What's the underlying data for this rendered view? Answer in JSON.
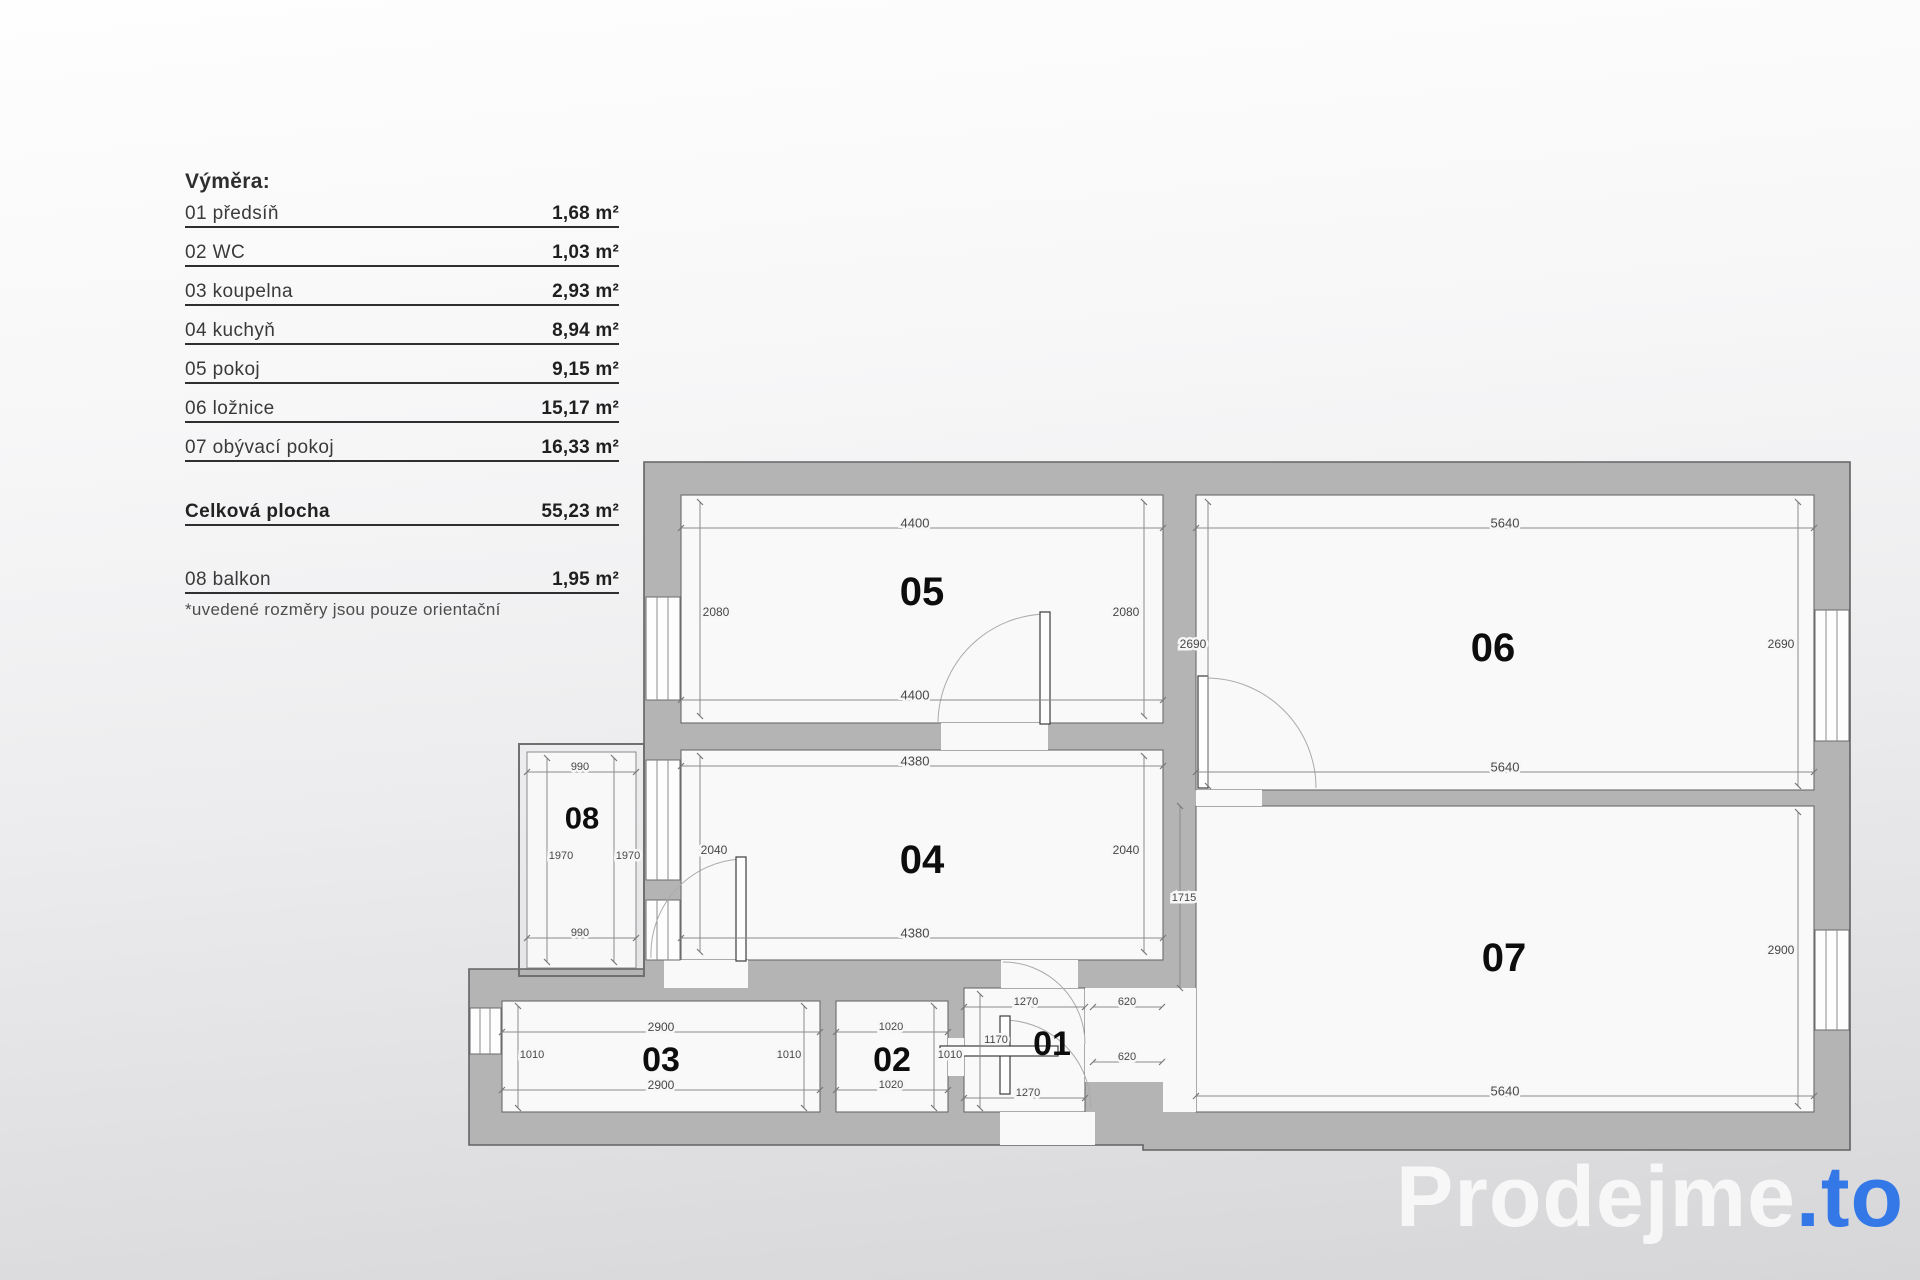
{
  "legend": {
    "title": "Výměra:",
    "rows": [
      {
        "label": "01 předsíň",
        "value": "1,68 m²"
      },
      {
        "label": "02 WC",
        "value": "1,03 m²"
      },
      {
        "label": "03 koupelna",
        "value": "2,93 m²"
      },
      {
        "label": "04 kuchyň",
        "value": "8,94 m²"
      },
      {
        "label": "05 pokoj",
        "value": "9,15 m²"
      },
      {
        "label": "06 ložnice",
        "value": "15,17 m²"
      },
      {
        "label": "07 obývací pokoj",
        "value": "16,33 m²"
      }
    ],
    "total": {
      "label": "Celková plocha",
      "value": "55,23 m²"
    },
    "balcony": {
      "label": "08 balkon",
      "value": "1,95 m²"
    },
    "note": "*uvedené rozměry jsou pouze orientační"
  },
  "plan": {
    "room_labels": [
      {
        "v": "05",
        "x": 922,
        "y": 592,
        "fs": 40
      },
      {
        "v": "06",
        "x": 1493,
        "y": 648,
        "fs": 40
      },
      {
        "v": "04",
        "x": 922,
        "y": 860,
        "fs": 40
      },
      {
        "v": "07",
        "x": 1504,
        "y": 958,
        "fs": 40
      },
      {
        "v": "08",
        "x": 582,
        "y": 818,
        "fs": 31
      },
      {
        "v": "03",
        "x": 661,
        "y": 1060,
        "fs": 34
      },
      {
        "v": "02",
        "x": 892,
        "y": 1060,
        "fs": 34
      },
      {
        "v": "01",
        "x": 1052,
        "y": 1044,
        "fs": 34
      }
    ],
    "dims": [
      {
        "v": "4400",
        "x1": 681,
        "y1": 528,
        "x2": 1163,
        "y2": 528,
        "tx": 915,
        "ty": 523,
        "fs": 13
      },
      {
        "v": "2080",
        "x1": 700,
        "y1": 502,
        "x2": 700,
        "y2": 716,
        "tx": 716,
        "ty": 612,
        "fs": 12
      },
      {
        "v": "2080",
        "x1": 1144,
        "y1": 502,
        "x2": 1144,
        "y2": 716,
        "tx": 1126,
        "ty": 612,
        "fs": 12
      },
      {
        "v": "4400",
        "x1": 681,
        "y1": 700,
        "x2": 1163,
        "y2": 700,
        "tx": 915,
        "ty": 695,
        "fs": 13
      },
      {
        "v": "5640",
        "x1": 1196,
        "y1": 528,
        "x2": 1814,
        "y2": 528,
        "tx": 1505,
        "ty": 523,
        "fs": 13
      },
      {
        "v": "2690",
        "x1": 1208,
        "y1": 502,
        "x2": 1208,
        "y2": 786,
        "tx": 1193,
        "ty": 644,
        "fs": 12
      },
      {
        "v": "2690",
        "x1": 1798,
        "y1": 502,
        "x2": 1798,
        "y2": 786,
        "tx": 1781,
        "ty": 644,
        "fs": 12
      },
      {
        "v": "5640",
        "x1": 1196,
        "y1": 772,
        "x2": 1814,
        "y2": 772,
        "tx": 1505,
        "ty": 767,
        "fs": 13
      },
      {
        "v": "4380",
        "x1": 681,
        "y1": 766,
        "x2": 1163,
        "y2": 766,
        "tx": 915,
        "ty": 761,
        "fs": 13
      },
      {
        "v": "2040",
        "x1": 700,
        "y1": 756,
        "x2": 700,
        "y2": 952,
        "tx": 714,
        "ty": 850,
        "fs": 12
      },
      {
        "v": "2040",
        "x1": 1144,
        "y1": 756,
        "x2": 1144,
        "y2": 952,
        "tx": 1126,
        "ty": 850,
        "fs": 12
      },
      {
        "v": "4380",
        "x1": 681,
        "y1": 938,
        "x2": 1163,
        "y2": 938,
        "tx": 915,
        "ty": 933,
        "fs": 13
      },
      {
        "v": "990",
        "x1": 527,
        "y1": 772,
        "x2": 636,
        "y2": 772,
        "tx": 580,
        "ty": 767,
        "fs": 11
      },
      {
        "v": "1970",
        "x1": 547,
        "y1": 758,
        "x2": 547,
        "y2": 962,
        "tx": 561,
        "ty": 856,
        "fs": 11
      },
      {
        "v": "1970",
        "x1": 614,
        "y1": 758,
        "x2": 614,
        "y2": 962,
        "tx": 628,
        "ty": 856,
        "fs": 11
      },
      {
        "v": "990",
        "x1": 527,
        "y1": 938,
        "x2": 636,
        "y2": 938,
        "tx": 580,
        "ty": 933,
        "fs": 11
      },
      {
        "v": "2900",
        "x1": 502,
        "y1": 1032,
        "x2": 820,
        "y2": 1032,
        "tx": 661,
        "ty": 1027,
        "fs": 12
      },
      {
        "v": "1010",
        "x1": 518,
        "y1": 1006,
        "x2": 518,
        "y2": 1108,
        "tx": 532,
        "ty": 1055,
        "fs": 11
      },
      {
        "v": "1010",
        "x1": 804,
        "y1": 1006,
        "x2": 804,
        "y2": 1108,
        "tx": 789,
        "ty": 1055,
        "fs": 11
      },
      {
        "v": "2900",
        "x1": 502,
        "y1": 1090,
        "x2": 820,
        "y2": 1090,
        "tx": 661,
        "ty": 1085,
        "fs": 12
      },
      {
        "v": "1020",
        "x1": 836,
        "y1": 1032,
        "x2": 948,
        "y2": 1032,
        "tx": 891,
        "ty": 1027,
        "fs": 11
      },
      {
        "v": "1010",
        "x1": 934,
        "y1": 1006,
        "x2": 934,
        "y2": 1108,
        "tx": 950,
        "ty": 1055,
        "fs": 11
      },
      {
        "v": "1020",
        "x1": 836,
        "y1": 1090,
        "x2": 948,
        "y2": 1090,
        "tx": 891,
        "ty": 1085,
        "fs": 11
      },
      {
        "v": "1270",
        "x1": 964,
        "y1": 1007,
        "x2": 1085,
        "y2": 1007,
        "tx": 1026,
        "ty": 1002,
        "fs": 11
      },
      {
        "v": "1170",
        "x1": 980,
        "y1": 994,
        "x2": 980,
        "y2": 1108,
        "tx": 996,
        "ty": 1040,
        "fs": 11
      },
      {
        "v": "1270",
        "x1": 964,
        "y1": 1098,
        "x2": 1085,
        "y2": 1098,
        "tx": 1028,
        "ty": 1093,
        "fs": 11
      },
      {
        "v": "620",
        "x1": 1093,
        "y1": 1007,
        "x2": 1162,
        "y2": 1007,
        "tx": 1127,
        "ty": 1002,
        "fs": 11
      },
      {
        "v": "620",
        "x1": 1093,
        "y1": 1062,
        "x2": 1162,
        "y2": 1062,
        "tx": 1127,
        "ty": 1057,
        "fs": 11
      },
      {
        "v": "1715",
        "x1": 1180,
        "y1": 806,
        "x2": 1180,
        "y2": 988,
        "tx": 1184,
        "ty": 898,
        "fs": 11
      },
      {
        "v": "5640",
        "x1": 1196,
        "y1": 1096,
        "x2": 1814,
        "y2": 1096,
        "tx": 1505,
        "ty": 1091,
        "fs": 13
      },
      {
        "v": "2900",
        "x1": 1798,
        "y1": 812,
        "x2": 1798,
        "y2": 1106,
        "tx": 1781,
        "ty": 950,
        "fs": 12
      }
    ]
  },
  "logo": {
    "brand": "Prodejme",
    "tld": ".to"
  },
  "colors": {
    "wall": "#b4b4b4",
    "wall_outline": "#636363",
    "room_fill": "#f9f9fa",
    "accent_blue": "#3478e8",
    "dim_text": "#474747"
  }
}
